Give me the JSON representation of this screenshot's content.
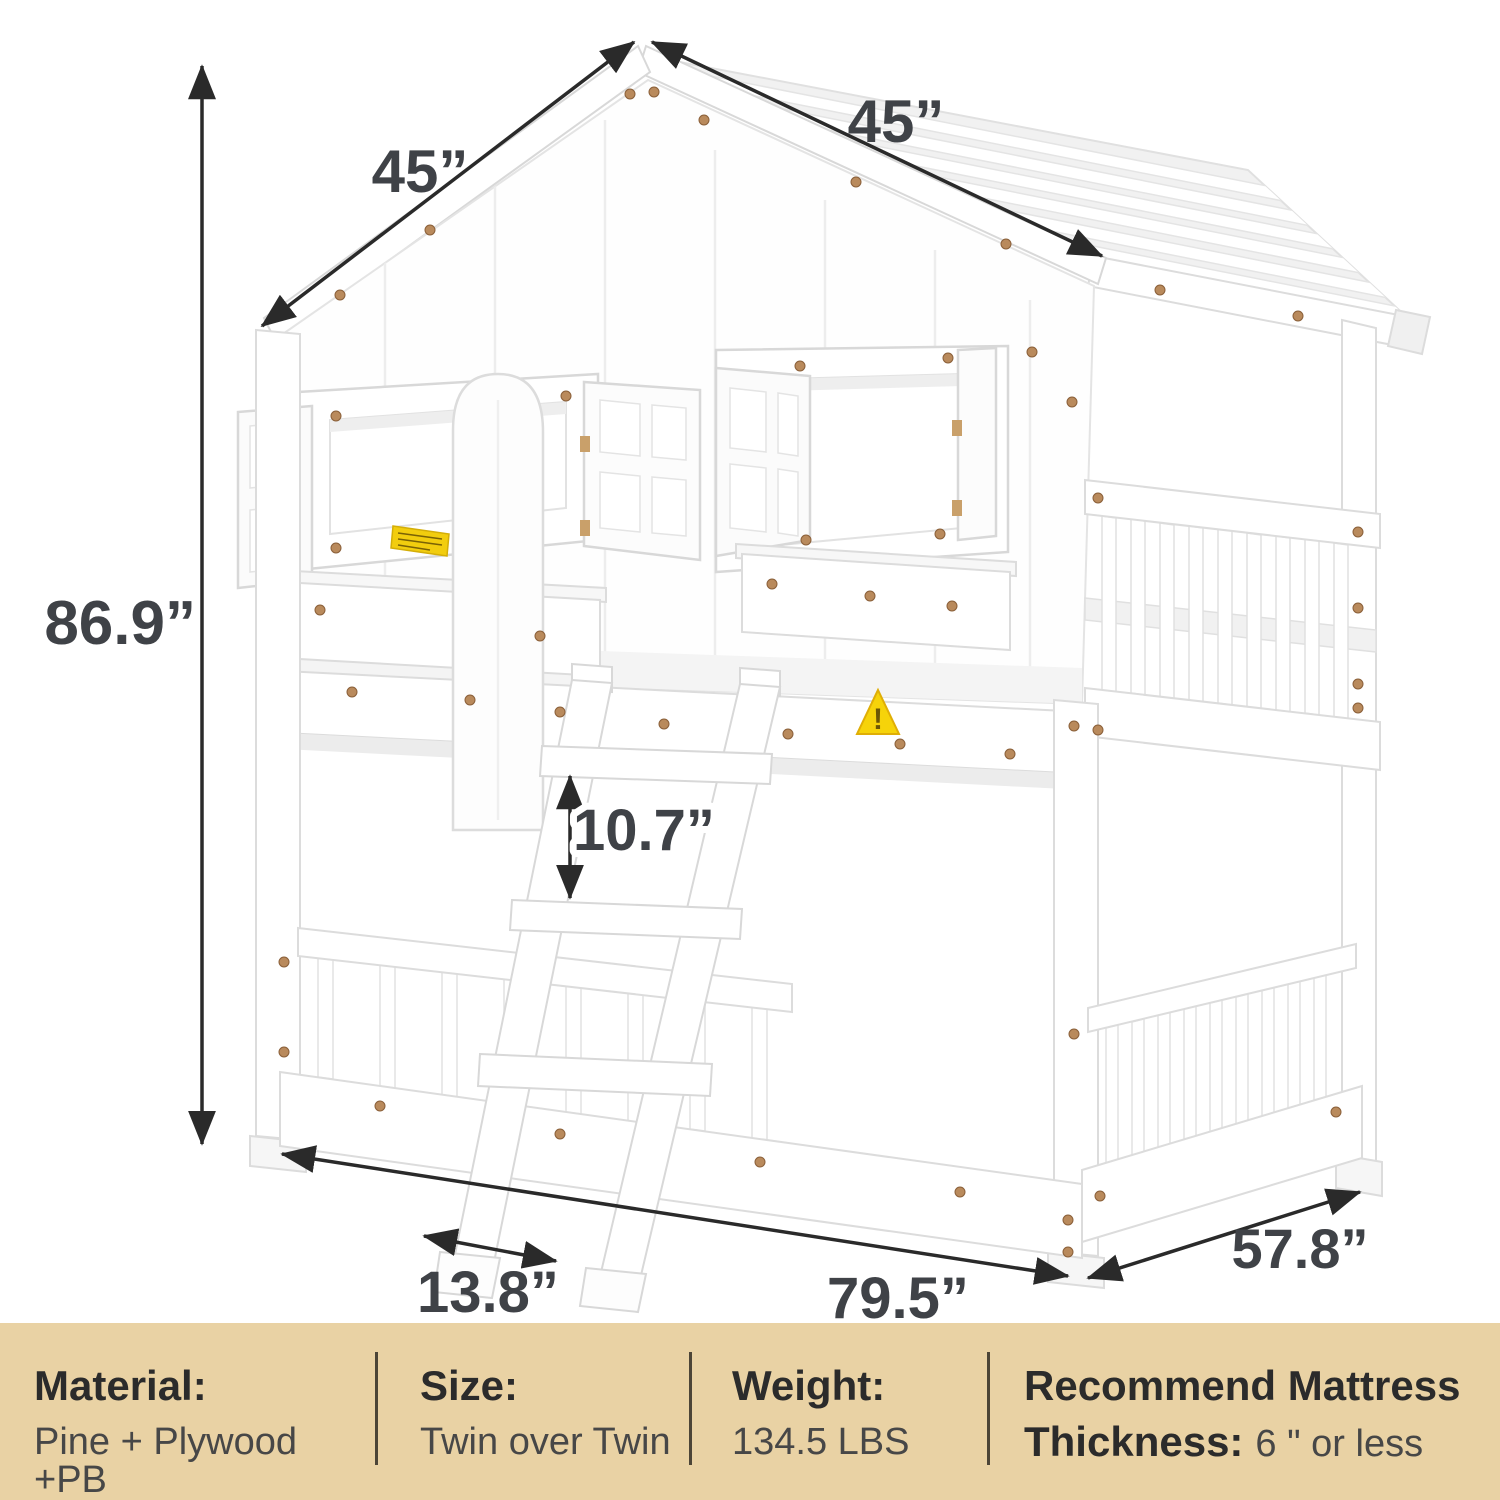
{
  "diagram": {
    "name": "House bunk bed dimension diagram",
    "dimensions": {
      "height": "86.9”",
      "roof_slope_left": "45”",
      "roof_slope_right": "45”",
      "ladder_step_spacing": "10.7”",
      "ladder_foot_distance": "13.8”",
      "bed_length": "79.5”",
      "bed_depth": "57.8”"
    },
    "warning_triangle_glyph": "!",
    "colors": {
      "arrow": "#2a2a2a",
      "dimension_text": "#3f4247",
      "screw": "#b98a5c",
      "warning_yellow": "#f2cd0e"
    }
  },
  "spec_bar": {
    "bg_color": "#e9d2a4",
    "divider_color": "#4c4537",
    "columns": [
      {
        "label": "Material:",
        "value": "Pine + Plywood +PB"
      },
      {
        "label": "Size:",
        "value": "Twin over Twin"
      },
      {
        "label": "Weight:",
        "value": "134.5 LBS"
      },
      {
        "label_line1": "Recommend Mattress",
        "label_line2": "Thickness:",
        "value": "6 \" or less"
      }
    ]
  }
}
